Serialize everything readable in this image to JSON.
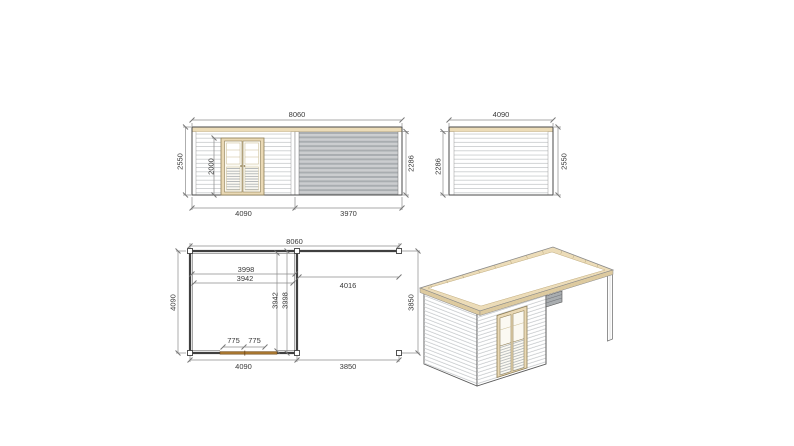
{
  "drawing": {
    "type": "technical-drawing-garden-cabin-with-canopy",
    "views": {
      "front_elevation": {
        "overall_width_mm": "8060",
        "cabin_width_mm": "4090",
        "canopy_width_mm": "3970",
        "total_height_mm": "2550",
        "door_height_mm": "2000",
        "wall_height_mm": "2286"
      },
      "side_elevation": {
        "depth_mm": "4090",
        "wall_height_mm": "2286",
        "total_height_mm": "2550"
      },
      "floor_plan": {
        "overall_width_mm": "8060",
        "inner_width_a_mm": "3998",
        "inner_width_b_mm": "3942",
        "canopy_clear_width_mm": "4016",
        "depth_mm": "4090",
        "inner_depth_a_mm": "3942",
        "inner_depth_b_mm": "3998",
        "door_leaf_left_mm": "775",
        "door_leaf_right_mm": "775",
        "cabin_width_mm": "4090",
        "canopy_width_mm": "3850",
        "canopy_depth_mm": "3850"
      },
      "isometric": {
        "description": "3D view of flat-roof cabin with side canopy and corner post"
      }
    },
    "colors": {
      "outline": "#4a4a4a",
      "dimension_line": "#8c8c8c",
      "dimension_text": "#3a3a3a",
      "wood_trim": "#ecdcb8",
      "door_wood": "#ead9b5",
      "plan_door_wood": "#a8762f",
      "shade_dark": "#a9adb0",
      "shade_light": "#cbcdcf"
    }
  }
}
